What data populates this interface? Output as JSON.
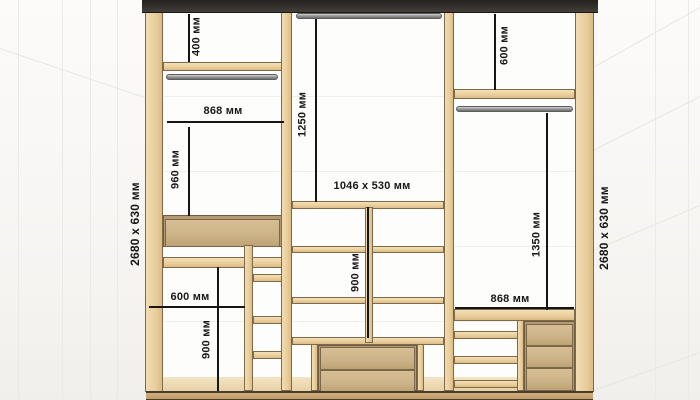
{
  "side_labels": {
    "left": "2680 x 630 мм",
    "right": "2680 x 630 мм"
  },
  "dims": {
    "left_top_height": "400 мм",
    "left_section_width": "868 мм",
    "left_hanging_height": "960 мм",
    "left_shelf_width": "600 мм",
    "left_lower_height": "900 мм",
    "center_hanging_height": "1250 мм",
    "center_opening_size": "1046 x 530 мм",
    "center_lower_height": "900 мм",
    "right_top_height": "600 мм",
    "right_hanging_height": "1350 мм",
    "right_section_width": "868 мм"
  },
  "colors": {
    "wood": "#eacf9e",
    "wood_edge": "#7e6a4b",
    "drawer_front": "#ccb287",
    "top_panel": "#36322d",
    "hanging_rod": "#9a9a9a",
    "dimension_ink": "#161616",
    "background": "#f6f4f1"
  }
}
